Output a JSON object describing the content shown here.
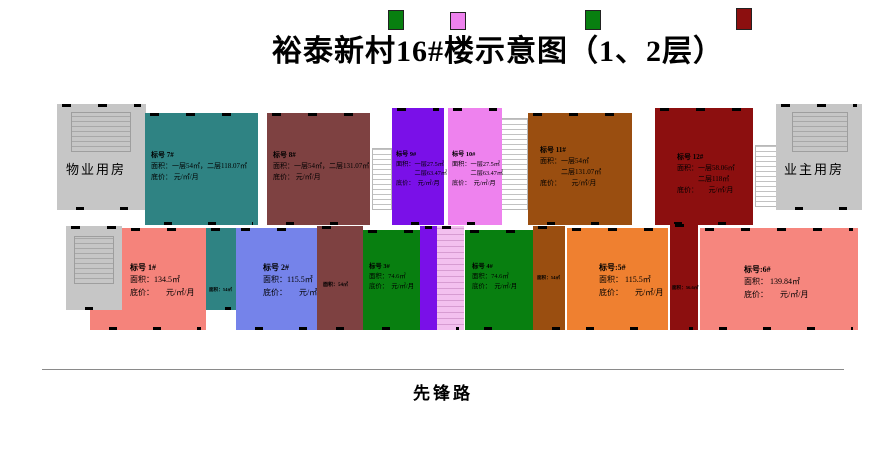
{
  "title": "裕泰新村16#楼示意图（1、2层）",
  "road_label": "先锋路",
  "left_block": {
    "label": "物业用房"
  },
  "right_block": {
    "label": "业主用房"
  },
  "colors": {
    "teal": "#2f8383",
    "maroon": "#7e4141",
    "purple": "#7a10e8",
    "violet": "#ee82ee",
    "brown": "#9a4e10",
    "darkred": "#8c0f0f",
    "salmon": "#f5837b",
    "periwinkle": "#7583ea",
    "green": "#087f10",
    "orange": "#ef8030",
    "pink": "#f6867e",
    "gray": "#c6c6c6"
  },
  "units": {
    "u7": {
      "color": "#2f8383",
      "lines": [
        "标号  7#",
        "面积：一层54㎡，二层118.07㎡",
        "底价：      元/㎡/月"
      ]
    },
    "u8": {
      "color": "#7e4141",
      "lines": [
        "标号  8#",
        "面积：一层54㎡，二层131.07㎡",
        "底价：      元/㎡/月"
      ]
    },
    "u9": {
      "color": "#7a10e8",
      "lines": [
        "标号  9#",
        "面积：一层27.5㎡",
        "　　　二层63.47㎡",
        "底价：　元/㎡/月"
      ]
    },
    "u10": {
      "color": "#ee82ee",
      "lines": [
        "标号  10#",
        "面积：一层27.5㎡",
        "　　　二层63.47㎡",
        "底价：　元/㎡/月"
      ]
    },
    "u11": {
      "color": "#9a4e10",
      "lines": [
        "标号  11#",
        "面积：一层54㎡",
        "　　　二层131.07㎡",
        "底价：　　元/㎡/月"
      ]
    },
    "u12": {
      "color": "#8c0f0f",
      "lines": [
        "标号  12#",
        "面积：一层58.06㎡",
        "　　　二层118㎡",
        "底价：　　元/㎡/月"
      ]
    },
    "u1": {
      "color": "#f5837b",
      "lines": [
        "标号  1#",
        "面积：134.5㎡",
        "底价：　　元/㎡/月"
      ]
    },
    "u2": {
      "color": "#7583ea",
      "lines": [
        "标号  2#",
        "面积：115.5㎡",
        "底价：　　元/㎡/月"
      ]
    },
    "u3": {
      "color": "#087f10",
      "lines": [
        "标号  3#",
        "面积：74.6㎡",
        "底价：　元/㎡/月"
      ]
    },
    "u4": {
      "color": "#087f10",
      "lines": [
        "标号  4#",
        "面积：74.6㎡",
        "底价：　元/㎡/月"
      ]
    },
    "u5": {
      "color": "#ef8030",
      "lines": [
        "标号:5#",
        "面积： 115.5㎡",
        "底价：　　元/㎡/月"
      ]
    },
    "u6": {
      "color": "#f6867e",
      "lines": [
        "标号:6#",
        "面积： 139.84㎡",
        "底价：　　元/㎡/月"
      ]
    }
  },
  "strips": {
    "s7": {
      "color": "#2f8383",
      "lines": [
        "面积：54㎡"
      ]
    },
    "s8": {
      "color": "#7e4141",
      "lines": [
        "面积：54㎡"
      ]
    },
    "s9": {
      "color": "#7a10e8",
      "lines": []
    },
    "s10": {
      "color": "#f3c0ef",
      "lines": []
    },
    "s11": {
      "color": "#9a4e10",
      "lines": [
        "面积：54㎡"
      ]
    },
    "s12": {
      "color": "#8c0f0f",
      "lines": [
        "面积：56.6㎡"
      ]
    }
  },
  "roof_blocks": [
    {
      "color": "#087f10"
    },
    {
      "color": "#ee82ee"
    },
    {
      "color": "#087f10"
    },
    {
      "color": "#8c0f0f"
    }
  ]
}
